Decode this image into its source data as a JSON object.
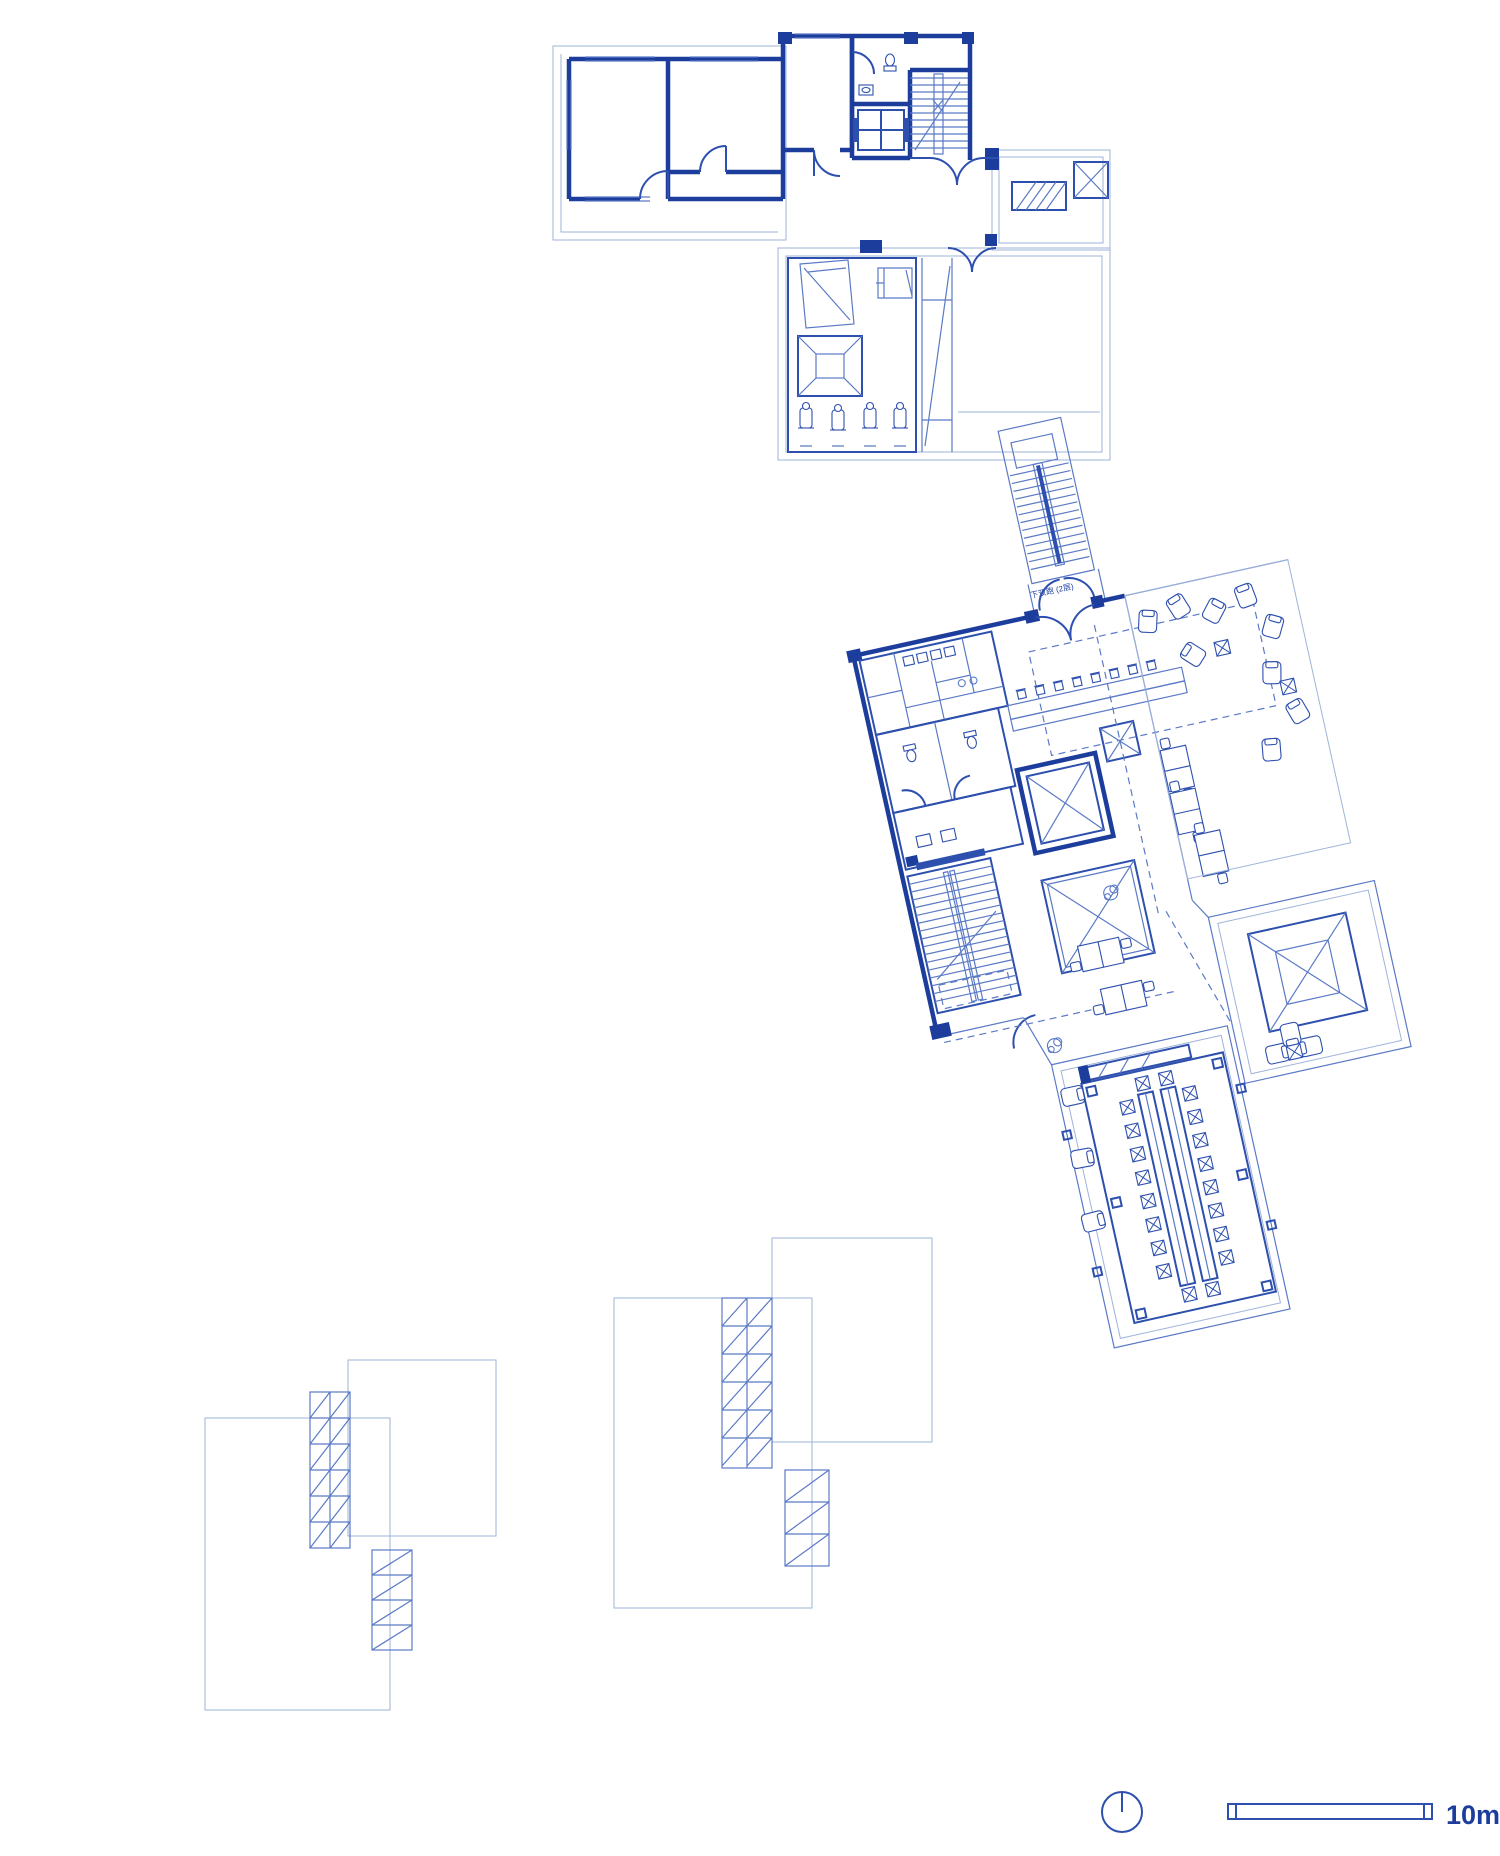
{
  "sheet": {
    "background": "#ffffff",
    "kind": "architectural-blueprint-sheet"
  },
  "colors": {
    "wall_dark": "#1d3d9c",
    "line_medium": "#2d4fae",
    "line_light": "#5b7ac6",
    "line_faint": "#9fb3da",
    "text": "#1d3d9c",
    "background": "#ffffff"
  },
  "plans": {
    "top": {
      "name": "upper-level-plan",
      "features": [
        "rooms",
        "bathroom",
        "elevator",
        "stair",
        "entry-doors",
        "terrace",
        "hatched-skylight",
        "x-shaft",
        "gym-room",
        "gym-equipment",
        "pyramid-skylight",
        "ramp"
      ]
    },
    "middle": {
      "name": "main-level-plan",
      "rotation_deg": -12.5,
      "stair_label": "下双跑 (2层)",
      "features": [
        "entry-stair-wing",
        "entry-double-doors",
        "service-rooms",
        "toilets",
        "bar-counter",
        "bar-stools",
        "elevator",
        "light-well",
        "main-stair",
        "office-desks",
        "lounge-terrace",
        "pyramid-skylight-pavilion",
        "conference-room",
        "long-tables",
        "conference-chairs"
      ]
    },
    "roof_left": {
      "name": "roof-plan-left",
      "features": [
        "roof-slab",
        "roof-slab-upper",
        "skylight-grid-band",
        "hatched-strip"
      ]
    },
    "roof_right": {
      "name": "roof-plan-right",
      "features": [
        "roof-slab",
        "roof-slab-upper",
        "skylight-grid-band",
        "hatched-strip"
      ]
    }
  },
  "legend": {
    "scale_label": "10m",
    "north_symbol": "circle-with-needle"
  }
}
